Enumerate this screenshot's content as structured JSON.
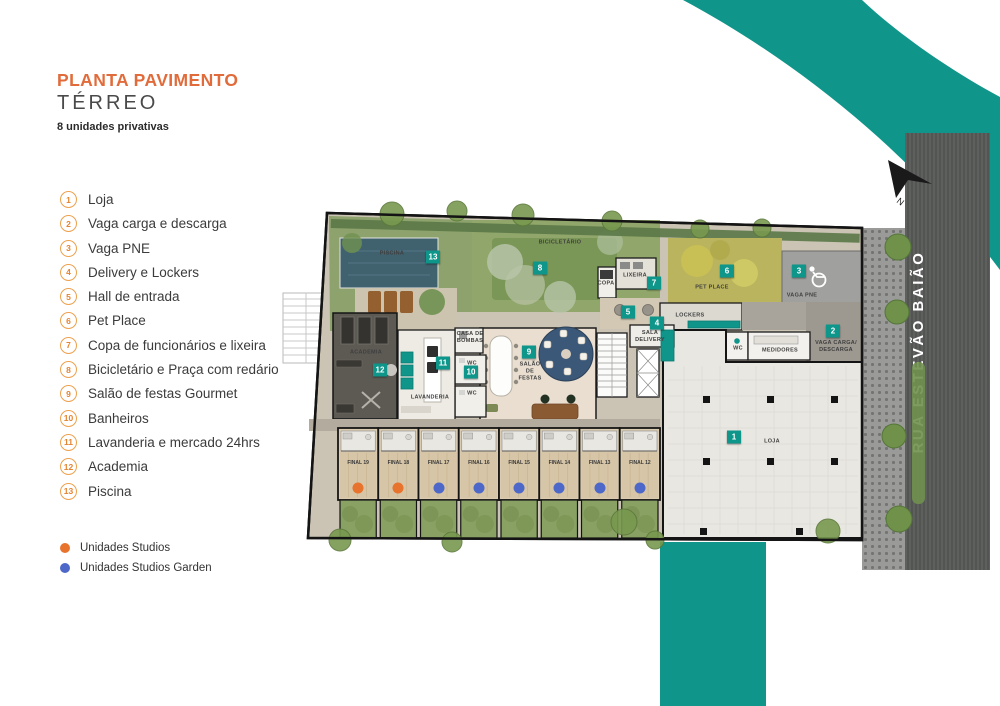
{
  "title": {
    "main": "PLANTA PAVIMENTO",
    "sub": "TÉRREO",
    "caption": "8 unidades privativas"
  },
  "legend": [
    {
      "num": "1",
      "label": "Loja"
    },
    {
      "num": "2",
      "label": "Vaga carga e descarga"
    },
    {
      "num": "3",
      "label": "Vaga PNE"
    },
    {
      "num": "4",
      "label": "Delivery e Lockers"
    },
    {
      "num": "5",
      "label": "Hall de entrada"
    },
    {
      "num": "6",
      "label": "Pet Place"
    },
    {
      "num": "7",
      "label": "Copa de funcionários e lixeira"
    },
    {
      "num": "8",
      "label": "Bicicletário e Praça com redário"
    },
    {
      "num": "9",
      "label": "Salão de festas Gourmet"
    },
    {
      "num": "10",
      "label": "Banheiros"
    },
    {
      "num": "11",
      "label": "Lavanderia e mercado 24hrs"
    },
    {
      "num": "12",
      "label": "Academia"
    },
    {
      "num": "13",
      "label": "Piscina"
    }
  ],
  "unit_types": [
    {
      "label": "Unidades Studios",
      "color": "#E8732C"
    },
    {
      "label": "Unidades Studios Garden",
      "color": "#4D68C8"
    }
  ],
  "street": {
    "name": "RUA ESTEVÃO BAIÃO"
  },
  "compass": {
    "label": "N"
  },
  "plan": {
    "colors": {
      "marker": "#0F968B",
      "studio_dot": "#E8732C",
      "garden_dot": "#4D68C8",
      "accent_teal": "#10958A"
    },
    "markers": [
      {
        "num": "1",
        "x": 734,
        "y": 437
      },
      {
        "num": "2",
        "x": 833,
        "y": 331
      },
      {
        "num": "3",
        "x": 799,
        "y": 271
      },
      {
        "num": "4",
        "x": 657,
        "y": 323
      },
      {
        "num": "5",
        "x": 628,
        "y": 312
      },
      {
        "num": "6",
        "x": 727,
        "y": 271
      },
      {
        "num": "7",
        "x": 654,
        "y": 283
      },
      {
        "num": "8",
        "x": 540,
        "y": 268
      },
      {
        "num": "9",
        "x": 529,
        "y": 352
      },
      {
        "num": "10",
        "x": 471,
        "y": 372
      },
      {
        "num": "11",
        "x": 443,
        "y": 363
      },
      {
        "num": "12",
        "x": 380,
        "y": 370
      },
      {
        "num": "13",
        "x": 433,
        "y": 257
      }
    ],
    "room_labels": [
      {
        "text": "PISCINA",
        "x": 392,
        "y": 254
      },
      {
        "text": "BICICLETÁRIO",
        "x": 560,
        "y": 243
      },
      {
        "text": "COPA",
        "x": 606,
        "y": 284
      },
      {
        "text": "LIXEIRA",
        "x": 635,
        "y": 276
      },
      {
        "text": "PET PLACE",
        "x": 712,
        "y": 288
      },
      {
        "text": "VAGA PNE",
        "x": 802,
        "y": 296
      },
      {
        "text": "LOCKERS",
        "x": 690,
        "y": 316
      },
      {
        "text": "SALA\nDELIVERY",
        "x": 650,
        "y": 337
      },
      {
        "text": "VAGA CARGA/\nDESCARGA",
        "x": 836,
        "y": 347
      },
      {
        "text": "MEDIDORES",
        "x": 780,
        "y": 351
      },
      {
        "text": "WC",
        "x": 738,
        "y": 349
      },
      {
        "text": "CASA DE\nBOMBAS",
        "x": 470,
        "y": 338
      },
      {
        "text": "WC",
        "x": 472,
        "y": 364
      },
      {
        "text": "WC",
        "x": 472,
        "y": 394
      },
      {
        "text": "SALÃO\nDE\nFESTAS",
        "x": 530,
        "y": 372
      },
      {
        "text": "LAVANDERIA",
        "x": 430,
        "y": 398
      },
      {
        "text": "ACADEMIA",
        "x": 366,
        "y": 353
      },
      {
        "text": "LOJA",
        "x": 772,
        "y": 442
      }
    ],
    "units": [
      {
        "label": "FINAL 19",
        "type": "studio"
      },
      {
        "label": "FINAL 18",
        "type": "studio"
      },
      {
        "label": "FINAL 17",
        "type": "garden"
      },
      {
        "label": "FINAL 16",
        "type": "garden"
      },
      {
        "label": "FINAL 15",
        "type": "garden"
      },
      {
        "label": "FINAL 14",
        "type": "garden"
      },
      {
        "label": "FINAL 13",
        "type": "garden"
      },
      {
        "label": "FINAL 12",
        "type": "garden"
      }
    ]
  }
}
